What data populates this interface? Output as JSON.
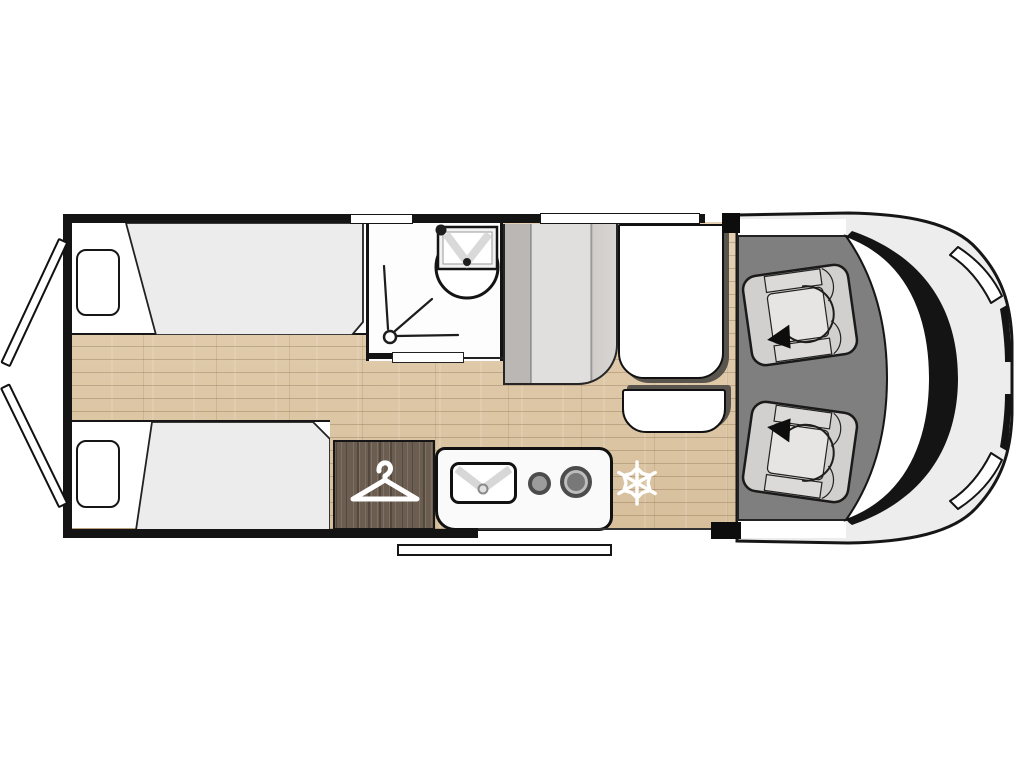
{
  "title": "campervan-floor-plan",
  "canvas": {
    "width": 1024,
    "height": 768
  },
  "colors": {
    "wall": "#141414",
    "wood_floor": "#dcc5a3",
    "cab_floor": "#7f7f7f",
    "body_gray": "#ededed",
    "duvet_gray": "#ececec",
    "bench_light": "#e1dfdd",
    "bench_dark": "#bab7b5",
    "shadow_dark": "#59554e",
    "wardrobe_wood": "#6b5d50",
    "seat_gray": "#d2d0ce",
    "seat_cushion": "#e7e5e3",
    "icon_white": "#ffffff"
  },
  "rooms": {
    "rear_bedroom": {
      "type": "twin-single-beds",
      "beds": 2,
      "pillows": 2,
      "rear_doors_open": 2
    },
    "bathroom": {
      "fixtures": [
        "washbasin",
        "toilet",
        "shower-drain"
      ],
      "door": "sliding-door"
    },
    "wardrobe": {
      "icon": "clothes-hanger"
    },
    "kitchen": {
      "fixtures": [
        "sink",
        "small-burner",
        "large-burner"
      ]
    },
    "refrigerator": {
      "icon": "snowflake"
    },
    "dinette": {
      "furniture": [
        "bench-seat",
        "table",
        "side-seat"
      ]
    },
    "cab": {
      "seats": [
        "swivel-seat-left",
        "swivel-seat-right"
      ],
      "features": [
        "windshield",
        "hood",
        "headlights"
      ]
    },
    "entry": {
      "feature": "entry-step"
    },
    "windows_top_wall": 2
  }
}
